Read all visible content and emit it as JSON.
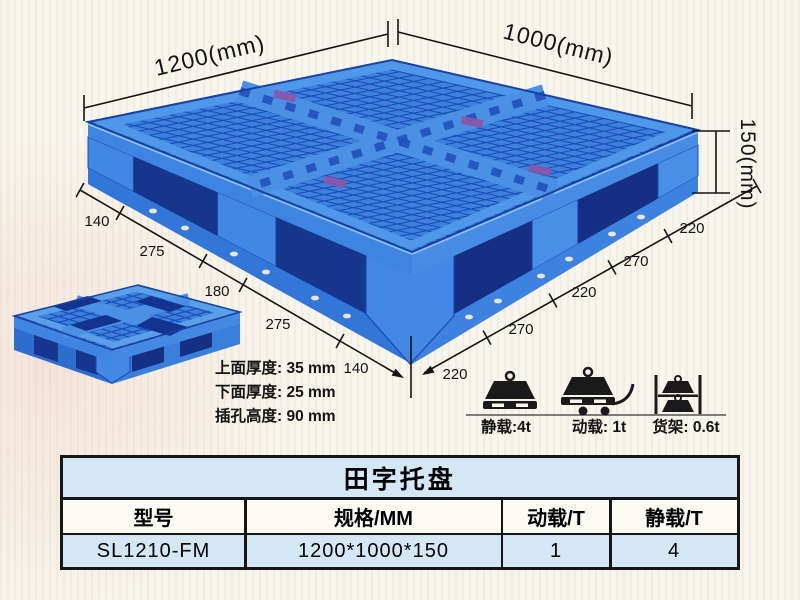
{
  "colors": {
    "pallet_blue": "#2e72d4",
    "pallet_light_blue": "#4f97e8",
    "pallet_dark_blue": "#16348e",
    "table_band_bg": "#d3e8f4",
    "line_black": "#141414",
    "background": "#f8f5ec"
  },
  "diagram": {
    "length_label": "1200(mm)",
    "width_label": "1000(mm)",
    "height_label": "150(mm)",
    "left_chain": [
      "140",
      "275",
      "180",
      "275",
      "140"
    ],
    "right_chain": [
      "220",
      "270",
      "220",
      "270",
      "220"
    ],
    "notes": [
      "上面厚度: 35 mm",
      "下面厚度: 25 mm",
      "插孔高度: 90 mm"
    ],
    "loads": [
      {
        "icon": "static-load-icon",
        "label": "静载:4t"
      },
      {
        "icon": "dynamic-load-icon",
        "label": "动载: 1t"
      },
      {
        "icon": "rack-load-icon",
        "label": "货架: 0.6t"
      }
    ]
  },
  "table": {
    "title": "田字托盘",
    "headers": [
      "型号",
      "规格/MM",
      "动载/T",
      "静载/T"
    ],
    "rows": [
      [
        "SL1210-FM",
        "1200*1000*150",
        "1",
        "4"
      ]
    ]
  }
}
